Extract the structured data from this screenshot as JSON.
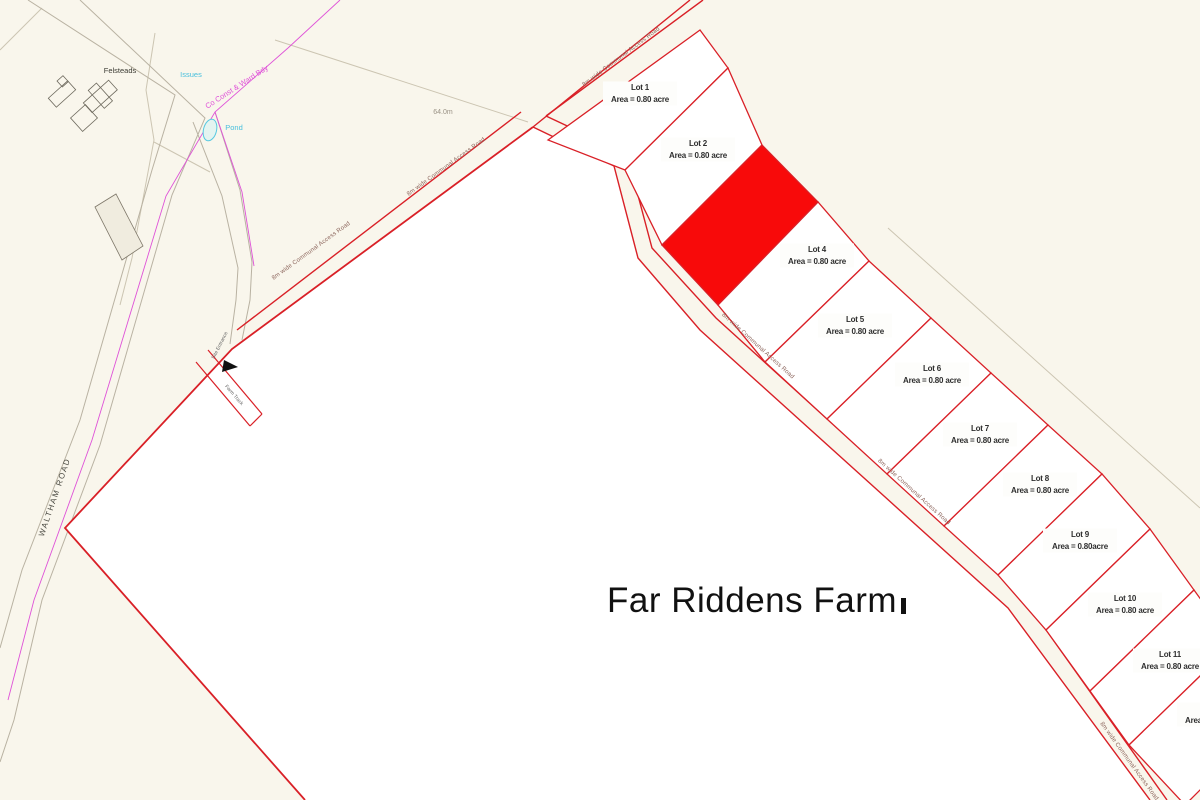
{
  "title_label": "Far Riddens Farm",
  "spot_height": "64.0m",
  "roads": {
    "waltham": "WALTHAM ROAD",
    "communal": "8m wide Communal Access Road",
    "farm_track": "Farm Track",
    "site_entrance": "Site Entrance"
  },
  "base": {
    "felsteads": "Felsteads",
    "issues": "Issues",
    "pond": "Pond",
    "county_boundary": "Co Const & Ward Bdy"
  },
  "lots": [
    {
      "name": "Lot 1",
      "area": "Area = 0.80 acre",
      "sold": false
    },
    {
      "name": "Lot 2",
      "area": "Area = 0.80 acre",
      "sold": false
    },
    {
      "name": "",
      "area": "",
      "sold": true
    },
    {
      "name": "Lot 4",
      "area": "Area = 0.80 acre",
      "sold": false
    },
    {
      "name": "Lot 5",
      "area": "Area = 0.80 acre",
      "sold": false
    },
    {
      "name": "Lot 6",
      "area": "Area = 0.80 acre",
      "sold": false
    },
    {
      "name": "Lot 7",
      "area": "Area = 0.80 acre",
      "sold": false
    },
    {
      "name": "Lot 8",
      "area": "Area = 0.80 acre",
      "sold": false
    },
    {
      "name": "Lot 9",
      "area": "Area = 0.80acre",
      "sold": false
    },
    {
      "name": "Lot 10",
      "area": "Area = 0.80 acre",
      "sold": false
    },
    {
      "name": "Lot 11",
      "area": "Area = 0.80 acre",
      "sold": false
    },
    {
      "name": "",
      "area": "Area = 0.80 acre",
      "sold": false,
      "partial": true
    }
  ],
  "colors": {
    "background": "#f9f6ec",
    "field_fill": "#ffffff",
    "boundary_red": "#d92027",
    "sold_red": "#f80a0a",
    "base_grey": "#ccc5b2",
    "cyan": "#56c8e0",
    "magenta": "#df52d8",
    "text_dark": "#2e2e2e"
  }
}
